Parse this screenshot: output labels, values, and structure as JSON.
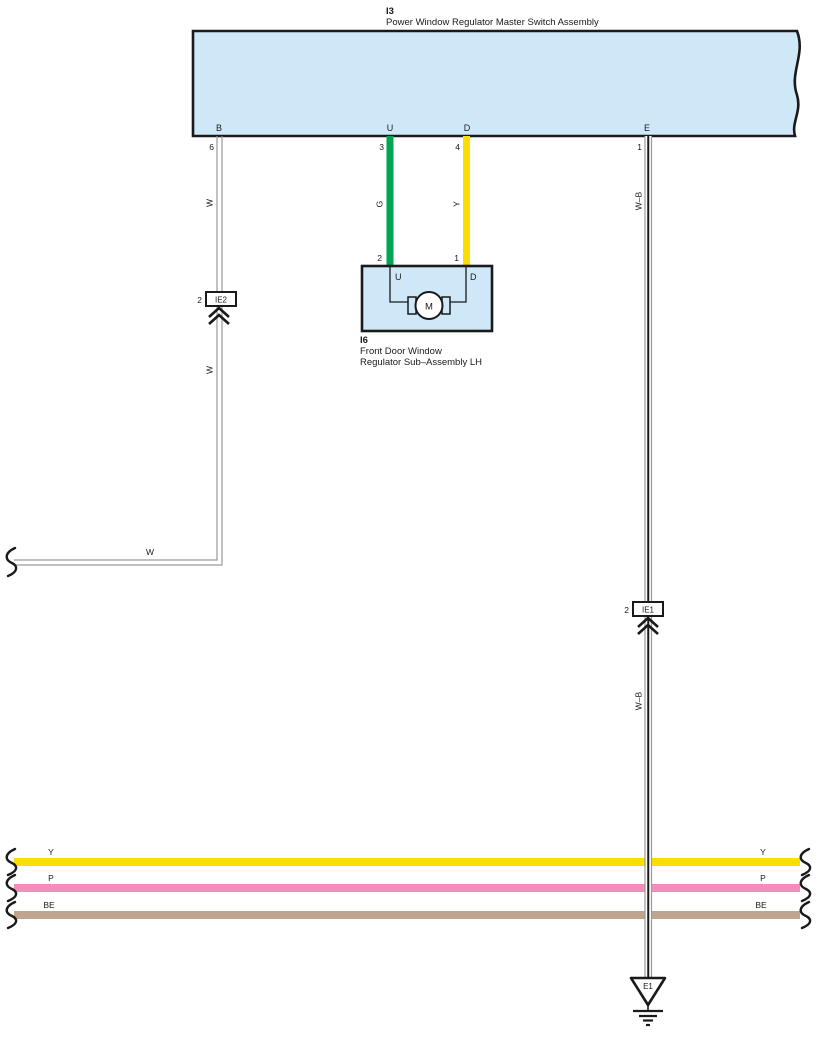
{
  "colors": {
    "component_fill": "#cfe8f8",
    "outline": "#1a1a1a",
    "wire_gray": "#9a9a9a",
    "wire_green": "#00a455",
    "wire_yellow": "#ffdd00",
    "wire_pink": "#f28cba",
    "wire_beige": "#c0a58e",
    "white": "#ffffff"
  },
  "master_switch": {
    "code": "I3",
    "title": "Power Window Regulator Master Switch Assembly",
    "pins": [
      {
        "letter": "B",
        "number": "6"
      },
      {
        "letter": "U",
        "number": "3"
      },
      {
        "letter": "D",
        "number": "4"
      },
      {
        "letter": "E",
        "number": "1"
      }
    ]
  },
  "regulator": {
    "code": "I6",
    "title_line1": "Front Door Window",
    "title_line2": "Regulator Sub–Assembly LH",
    "pins": [
      {
        "letter": "U",
        "number": "2"
      },
      {
        "letter": "D",
        "number": "1"
      }
    ],
    "motor": "M"
  },
  "connectors": [
    {
      "code": "IE2",
      "pin": "2"
    },
    {
      "code": "IE1",
      "pin": "2"
    }
  ],
  "ground": {
    "code": "E1"
  },
  "wire_labels": {
    "w_upper": "W",
    "w_mid": "W",
    "w_branch": "W",
    "green": "G",
    "yellow": "Y",
    "wb_upper": "W–B",
    "wb_lower": "W–B"
  },
  "bus_wires": [
    {
      "label_left": "Y",
      "label_right": "Y"
    },
    {
      "label_left": "P",
      "label_right": "P"
    },
    {
      "label_left": "BE",
      "label_right": "BE"
    }
  ]
}
